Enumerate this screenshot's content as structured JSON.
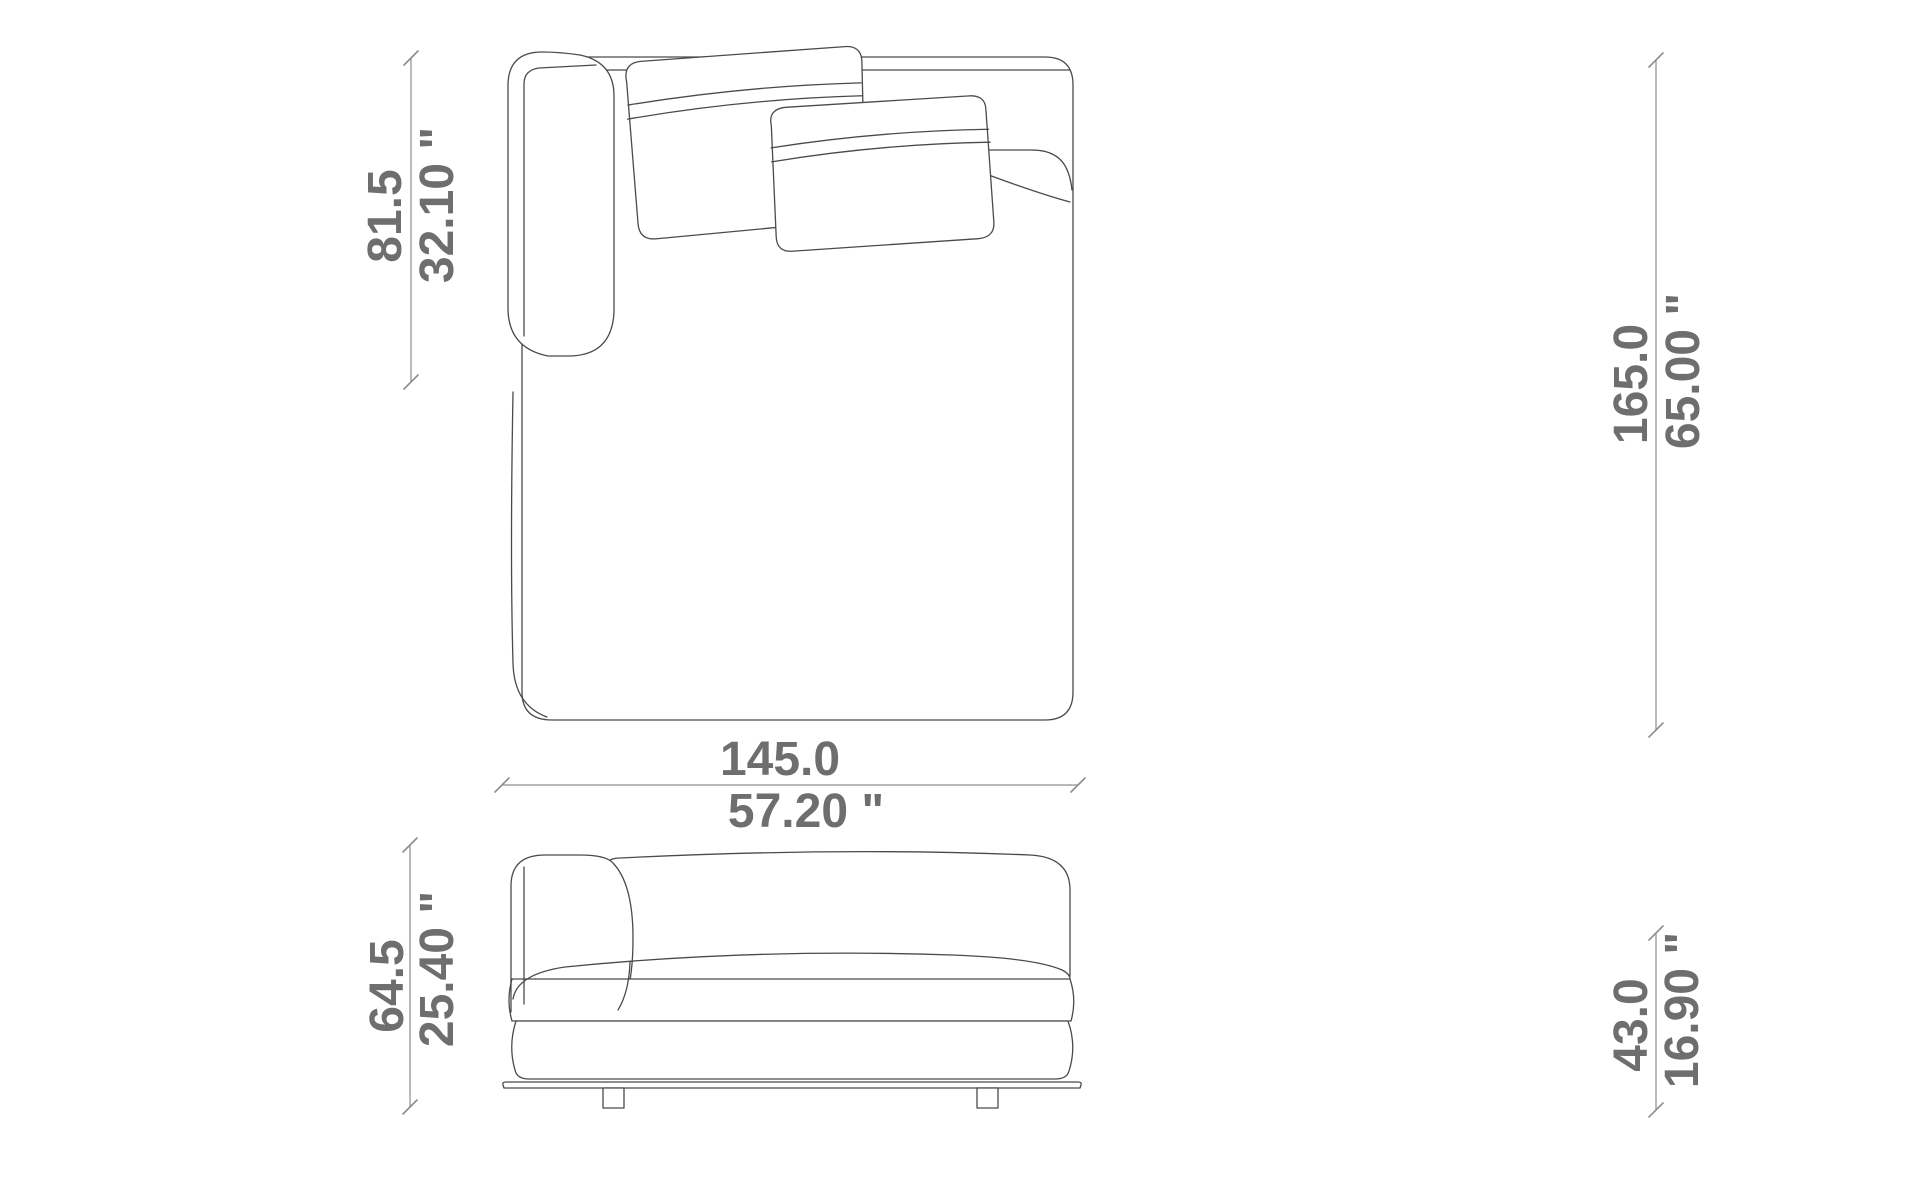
{
  "page": {
    "width_px": 1920,
    "height_px": 1200,
    "background": "#ffffff"
  },
  "drawing": {
    "kind": "furniture technical drawing (sofa chaise module, line art)",
    "views": {
      "top": "top view (plan) with left armrest and two back cushions",
      "front": "front view (elevation) with seat, base cushion, plinth and two feet"
    },
    "line_color": "#4a4a4a",
    "dimension_line_color": "#8d8d8d",
    "dimension_text_color": "#6e6e6e"
  },
  "dimensions": {
    "armrest_length": {
      "cm": "81.5",
      "inches": "32.10 \""
    },
    "overall_depth": {
      "cm": "165.0",
      "inches": "65.00 \""
    },
    "overall_width": {
      "cm": "145.0",
      "inches": "57.20 \""
    },
    "overall_height": {
      "cm": "64.5",
      "inches": "25.40 \""
    },
    "seat_height": {
      "cm": "43.0",
      "inches": "16.90 \""
    }
  }
}
